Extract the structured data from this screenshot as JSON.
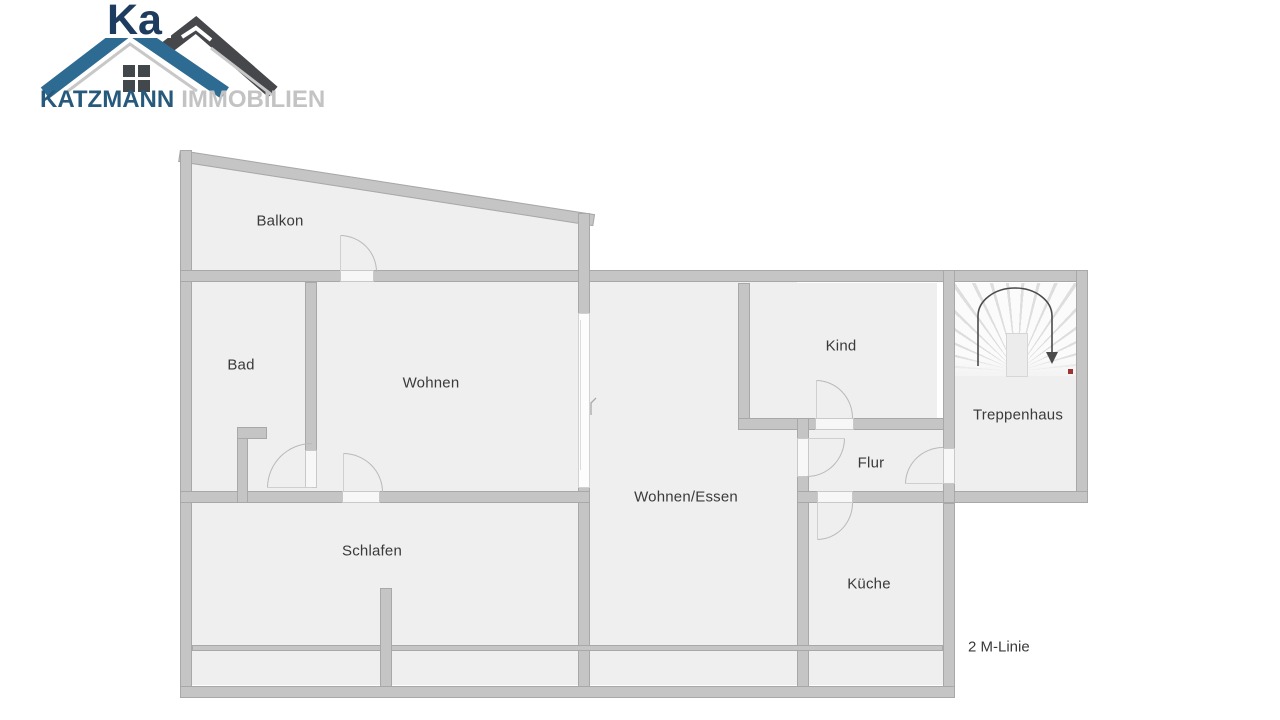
{
  "brand": {
    "name": "KATZMANN",
    "suffix": "IMMOBILIEN",
    "watermark_text": "Ka"
  },
  "floorplan": {
    "rooms": {
      "balkon": "Balkon",
      "bad": "Bad",
      "wohnen": "Wohnen",
      "schlafen": "Schlafen",
      "wohnen_essen": "Wohnen/Essen",
      "kind": "Kind",
      "flur": "Flur",
      "kueche": "Küche",
      "treppenhaus": "Treppenhaus"
    },
    "annotation_2m": "2 M-Linie"
  },
  "colors": {
    "logo_blue": "#2e6b93",
    "logo_dark_roof": "#46474b",
    "brand_text": "#27597d",
    "brand_suffix": "#c3c3c3",
    "wall_fill": "#c5c5c5",
    "wall_edge": "#a8a8a8",
    "room_fill": "#efefef",
    "label_text": "#3a3a3a",
    "stair_marker_red": "#9b3434"
  }
}
